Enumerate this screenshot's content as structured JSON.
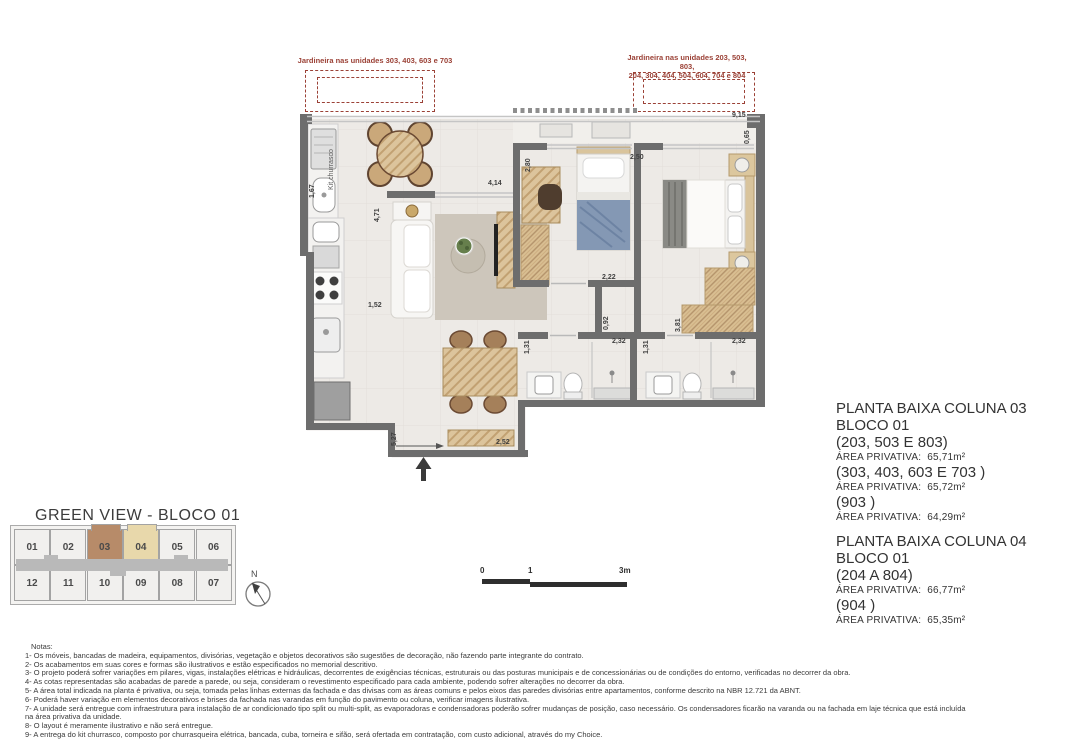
{
  "jardineiras": {
    "left": {
      "label": "Jardineira nas unidades 303, 403, 603 e 703"
    },
    "right": {
      "label_line1": "Jardineira nas unidades 203, 503, 803,",
      "label_line2": "204, 304, 404, 504, 604, 704 e 804"
    }
  },
  "plan": {
    "room_labels": [
      {
        "t": "Kit churrasco",
        "x": 36,
        "y": 98,
        "v": 1
      }
    ],
    "dimensions": [
      {
        "t": "1,67",
        "x": 17,
        "y": 106,
        "v": 1
      },
      {
        "t": "4,71",
        "x": 82,
        "y": 130,
        "v": 1
      },
      {
        "t": "1,52",
        "x": 76,
        "y": 210,
        "v": 0
      },
      {
        "t": "4,14",
        "x": 196,
        "y": 88,
        "v": 0
      },
      {
        "t": "2,80",
        "x": 233,
        "y": 80,
        "v": 1
      },
      {
        "t": "2,50",
        "x": 338,
        "y": 62,
        "v": 0
      },
      {
        "t": "9,15",
        "x": 440,
        "y": 20,
        "v": 0
      },
      {
        "t": "0,65",
        "x": 452,
        "y": 52,
        "v": 1
      },
      {
        "t": "2,22",
        "x": 310,
        "y": 182,
        "v": 0
      },
      {
        "t": "0,92",
        "x": 311,
        "y": 238,
        "v": 1
      },
      {
        "t": "3,81",
        "x": 383,
        "y": 240,
        "v": 1
      },
      {
        "t": "1,31",
        "x": 232,
        "y": 262,
        "v": 1
      },
      {
        "t": "2,32",
        "x": 320,
        "y": 246,
        "v": 0
      },
      {
        "t": "1,31",
        "x": 351,
        "y": 262,
        "v": 1
      },
      {
        "t": "2,32",
        "x": 440,
        "y": 246,
        "v": 0
      },
      {
        "t": "5,27",
        "x": 99,
        "y": 354,
        "v": 1
      },
      {
        "t": "2,52",
        "x": 204,
        "y": 347,
        "v": 0
      }
    ]
  },
  "info_panel": {
    "blocks": [
      {
        "title": "PLANTA BAIXA COLUNA 03",
        "subtitle": "BLOCO 01",
        "entries": [
          {
            "units": "(203, 503 E 803)",
            "label": "ÁREA PRIVATIVA:",
            "value": "65,71m²"
          },
          {
            "units": "(303, 403, 603 E 703 )",
            "label": "ÁREA PRIVATIVA:",
            "value": "65,72m²"
          },
          {
            "units": "(903 )",
            "label": "ÁREA PRIVATIVA:",
            "value": "64,29m²"
          }
        ]
      },
      {
        "title": "PLANTA BAIXA COLUNA 04",
        "subtitle": "BLOCO 01",
        "entries": [
          {
            "units": "(204 A 804)",
            "label": "ÁREA PRIVATIVA:",
            "value": "66,77m²"
          },
          {
            "units": "(904 )",
            "label": "ÁREA PRIVATIVA:",
            "value": "65,35m²"
          }
        ]
      }
    ]
  },
  "keyplan": {
    "title": "GREEN VIEW  -  BLOCO 01",
    "rows": [
      [
        "01",
        "02",
        "03",
        "04",
        "05",
        "06"
      ],
      [
        "12",
        "11",
        "10",
        "09",
        "08",
        "07"
      ]
    ],
    "highlight": {
      "03": "#b78b69",
      "04": "#e8d8ab"
    },
    "north_label": "N"
  },
  "scale_bar": {
    "start": "0",
    "mid": "1",
    "end": "3m"
  },
  "notes": {
    "heading": "Notas:",
    "items": [
      "1- Os móveis, bancadas de madeira, equipamentos, divisórias, vegetação e objetos decorativos são sugestões de decoração, não fazendo parte integrante do contrato.",
      "2- Os acabamentos em suas cores e formas são ilustrativos e estão especificados no memorial descritivo.",
      "3- O projeto poderá sofrer variações em pilares, vigas, instalações elétricas e hidráulicas, decorrentes de exigências técnicas, estruturais ou das posturas municipais e de concessionárias ou de condições do entorno, verificadas no decorrer da obra.",
      "4- As cotas representadas são acabadas de parede a parede, ou seja, consideram o revestimento especificado para cada ambiente, podendo sofrer alterações no decorrer da obra.",
      "5- A área total indicada na planta é privativa, ou seja, tomada pelas linhas externas da fachada e das divisas com as áreas comuns e pelos eixos das paredes divisórias entre apartamentos, conforme descrito na NBR 12.721 da ABNT.",
      "6- Poderá haver variação em elementos decorativos e brises da fachada nas varandas em função do pavimento ou coluna, verificar imagens ilustrativa.",
      "7- A unidade será entregue com infraestrutura para instalação de ar condicionado tipo split ou multi-split, as evaporadoras e condensadoras poderão sofrer mudanças de posição, caso necessário. Os condensadores ficarão na varanda ou na fachada em laje técnica que está incluída na área privativa da unidade.",
      "8- O layout é meramente ilustrativo e não será entregue.",
      "9- A entrega do kit churrasco, composto por churrasqueira elétrica, bancada, cuba, torneira e sifão, será ofertada em contratação, com custo adicional, através do my Choice."
    ]
  }
}
